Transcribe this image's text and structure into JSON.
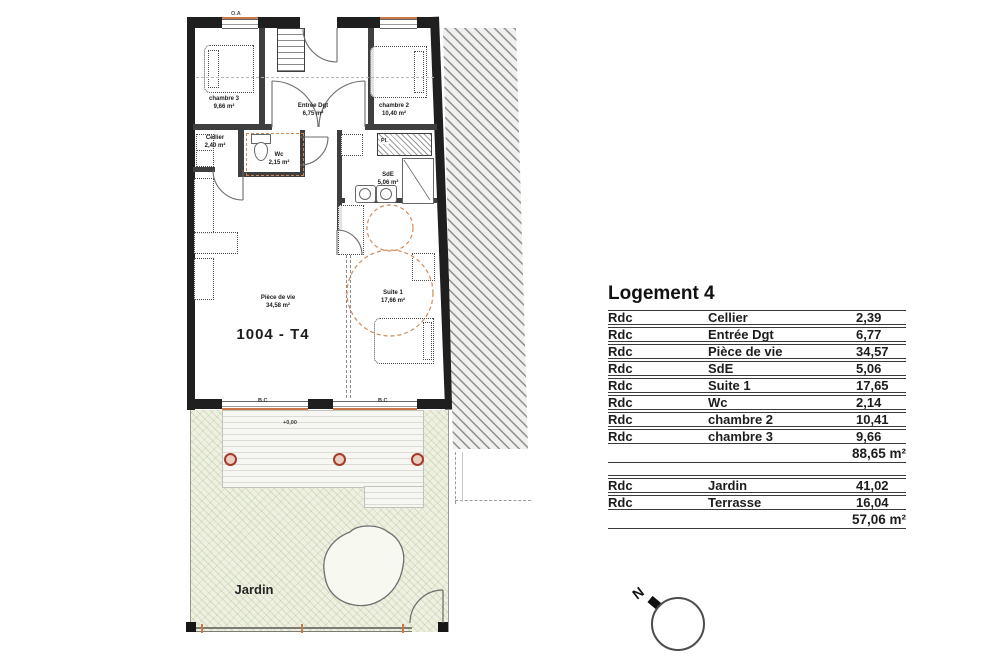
{
  "plan": {
    "unit_label": "1004 - T4",
    "rooms": [
      {
        "name": "chambre 3",
        "area": "9,66 m²"
      },
      {
        "name": "Entrée Dgt",
        "area": "6,75 m²"
      },
      {
        "name": "chambre 2",
        "area": "10,40 m²"
      },
      {
        "name": "Cellier",
        "area": "2,40 m²"
      },
      {
        "name": "Wc",
        "area": "2,15 m²"
      },
      {
        "name": "SdE",
        "area": "5,06 m²"
      },
      {
        "name": "Suite 1",
        "area": "17,66 m²"
      },
      {
        "name": "Pièce de vie",
        "area": "34,58 m²"
      }
    ],
    "level_marks": {
      "terrace": "+0,00"
    },
    "window_codes": {
      "top": "O.A",
      "bay_left": "B.C",
      "bay_right": "B.C"
    },
    "wardrobe_label": "Pl.",
    "outdoor": {
      "jardin_label": "Jardin"
    }
  },
  "table": {
    "title": "Logement 4",
    "sections": [
      {
        "rows": [
          {
            "level": "Rdc",
            "room": "Cellier",
            "area": "2,39"
          },
          {
            "level": "Rdc",
            "room": "Entrée Dgt",
            "area": "6,77"
          },
          {
            "level": "Rdc",
            "room": "Pièce de vie",
            "area": "34,57"
          },
          {
            "level": "Rdc",
            "room": "SdE",
            "area": "5,06"
          },
          {
            "level": "Rdc",
            "room": "Suite 1",
            "area": "17,65"
          },
          {
            "level": "Rdc",
            "room": "Wc",
            "area": "2,14"
          },
          {
            "level": "Rdc",
            "room": "chambre 2",
            "area": "10,41"
          },
          {
            "level": "Rdc",
            "room": "chambre 3",
            "area": "9,66"
          }
        ],
        "total": "88,65 m²"
      },
      {
        "rows": [
          {
            "level": "Rdc",
            "room": "Jardin",
            "area": "41,02"
          },
          {
            "level": "Rdc",
            "room": "Terrasse",
            "area": "16,04"
          }
        ],
        "total": "57,06 m²"
      }
    ]
  },
  "compass": {
    "north_label": "N"
  },
  "colors": {
    "wall": "#1f1f1f",
    "accent_orange": "#c9784a",
    "garden_green": "#eef1e1",
    "post_red": "#a53b2a"
  }
}
